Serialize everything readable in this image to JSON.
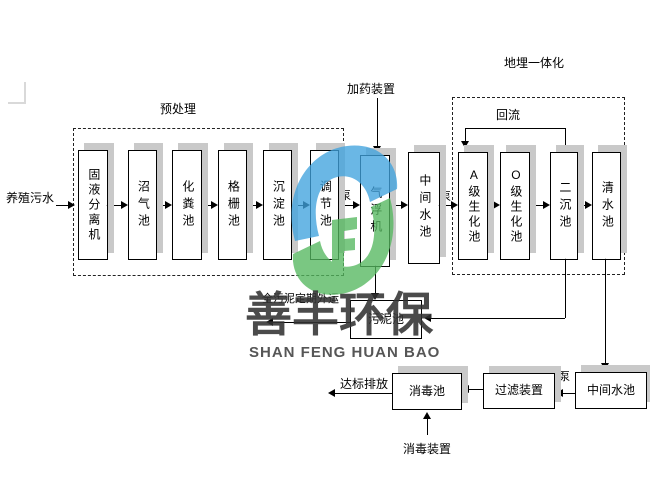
{
  "labels": {
    "influent": "养殖污水",
    "pretreatment": "预处理",
    "dosing_device": "加药装置",
    "buried_integration": "地埋一体化",
    "reflux": "回流",
    "pump": "泵",
    "sludge_out": "全污泥定期外运",
    "discharge": "达标排放",
    "disinfect_device": "消毒装置"
  },
  "boxes": {
    "separator": "固液分离机",
    "biogas": "沼气池",
    "septic": "化粪池",
    "grid": "格栅池",
    "sediment": "沉淀池",
    "regulating": "调节池",
    "flotation": "气浮机",
    "mid_pool1": "中间水池",
    "a_bio": "A级生化池",
    "o_bio": "O级生化池",
    "secondary": "二沉池",
    "clear_water": "清水池",
    "sludge": "污泥池",
    "disinfect": "消毒池",
    "filter": "过滤装置",
    "mid_pool2": "中间水池"
  },
  "watermark": {
    "cn": "善丰环保",
    "en": "SHAN FENG HUAN BAO",
    "logo_blue": "#41a3de",
    "logo_green": "#55b85f",
    "text_color": "#3a3a3a"
  }
}
